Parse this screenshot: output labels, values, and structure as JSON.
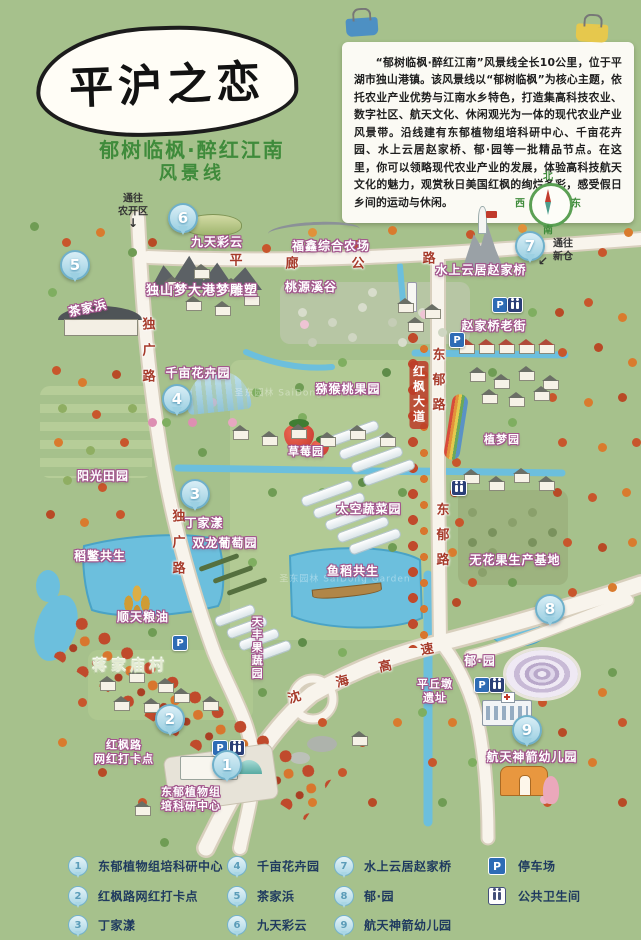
{
  "title": {
    "main": "平沪之恋",
    "subtitle_line1": "郁树临枫·醉红江南",
    "subtitle_line2": "风景线"
  },
  "description": "“郁树临枫·醉红江南”风景线全长10公里，位于平湖市独山港镇。该风景线以“郁树临枫”为核心主题，依托农业产业优势与江南水乡特色，打造集高科技农业、数字社区、航天文化、休闲观光为一体的现代农业产业风景带。沿线建有东郁植物组培科研中心、千亩花卉园、水上云居赵家桥、郁·园等一批精品节点。在这里，你可以领略现代农业产业的发展，体验高科技航天文化的魅力，观赏秋日美国红枫的绚烂多彩，感受假日乡间的运动与休闲。",
  "compass": {
    "n": "北",
    "s": "南",
    "w": "西",
    "e": "东"
  },
  "map": {
    "labels": {
      "jiutiancaiyun": "九天彩云",
      "fuxin": "福鑫综合农场",
      "taoyuan": "桃源溪谷",
      "dushanmeng": "独山梦大港梦雕塑",
      "chajiabang": "茶家浜",
      "shuishang": "水上云居赵家桥",
      "laojie": "赵家桥老街",
      "qianmu": "千亩花卉园",
      "mihoutao": "猕猴桃果园",
      "zhimeng": "植梦园",
      "caomei": "草莓园",
      "yangguang": "阳光田园",
      "taikong": "太空蔬菜园",
      "dingjiayang": "丁家漾",
      "shuanglong": "双龙葡萄园",
      "daobie": "稻鳖共生",
      "yudao": "鱼稻共生",
      "wuhuaguo": "无花果生产基地",
      "shuntian": "顺天粮油",
      "jiangjiamiao": "蒋家庙村",
      "tianfeng": "天丰果蔬园",
      "yuyuan": "郁·园",
      "pingqiudun": "平丘墩\n遗址",
      "hangtian": "航天神箭幼儿园",
      "hongfenglu": "红枫路\n网红打卡点",
      "dongyu_center": "东郁植物组\n培科研中心"
    },
    "roads": {
      "pinglang": [
        "平",
        "廊",
        "公",
        "路"
      ],
      "shenhai": [
        "沈",
        "海",
        "高",
        "速"
      ],
      "dongyulu": "东郁路",
      "duguanglu": "独广路",
      "hongfengdadao": "红枫大道"
    },
    "exits": {
      "top": "通往\n农开区",
      "right": "通往\n新仓"
    },
    "markers": [
      "1",
      "2",
      "3",
      "4",
      "5",
      "6",
      "7",
      "8",
      "9"
    ],
    "facility": {
      "p": "P"
    },
    "watermark": "圣东园林 SaiDong Garden"
  },
  "legend": {
    "items": [
      {
        "num": "1",
        "label": "东郁植物组培科研中心"
      },
      {
        "num": "2",
        "label": "红枫路网红打卡点"
      },
      {
        "num": "3",
        "label": "丁家漾"
      },
      {
        "num": "4",
        "label": "千亩花卉园"
      },
      {
        "num": "5",
        "label": "茶家浜"
      },
      {
        "num": "6",
        "label": "九天彩云"
      },
      {
        "num": "7",
        "label": "水上云居赵家桥"
      },
      {
        "num": "8",
        "label": "郁·园"
      },
      {
        "num": "9",
        "label": "航天神箭幼儿园"
      }
    ],
    "parking": {
      "icon": "P",
      "label": "停车场"
    },
    "toilet": {
      "label": "公共卫生间"
    }
  },
  "colors": {
    "bg": "#a6c18c",
    "water": "#6cbfdd",
    "road": "#f8f4ec",
    "label_outline": "#a2548c",
    "maple": "#c04a2c",
    "pin": "#9cd0e2"
  }
}
